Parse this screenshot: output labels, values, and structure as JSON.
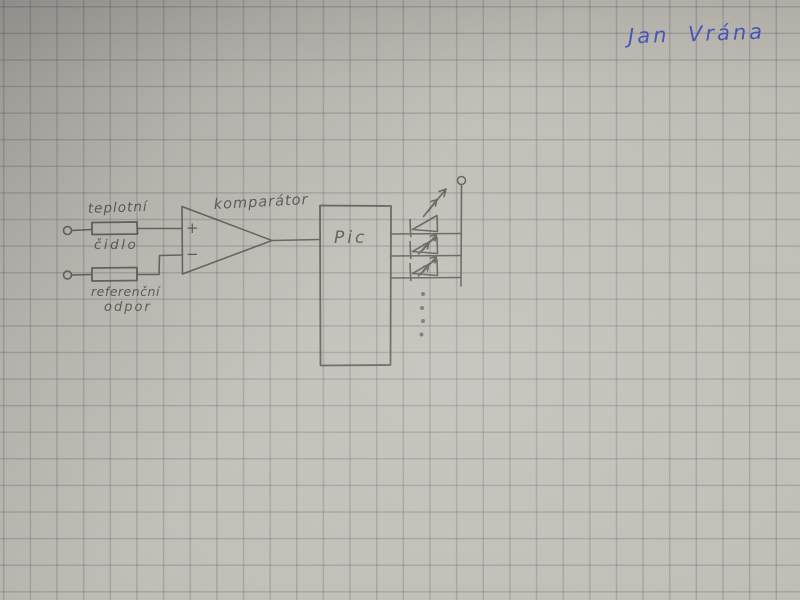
{
  "signature": {
    "text": "Jan Vrána"
  },
  "schematic": {
    "sensor_label_top": "teplotní",
    "sensor_label_bottom": "čidlo",
    "reference_label_line1": "referenční",
    "reference_label_line2": "odpor",
    "comparator_label": "komparátor",
    "comparator_plus": "+",
    "comparator_minus": "−",
    "mcu_label": "Pic",
    "led_count": 3,
    "more_outputs_dots": 4
  },
  "colors": {
    "paper": "#c1beb7",
    "grid_line": "#646a73",
    "pencil": "#504e4a",
    "ink_blue": "#4a5ac2"
  }
}
